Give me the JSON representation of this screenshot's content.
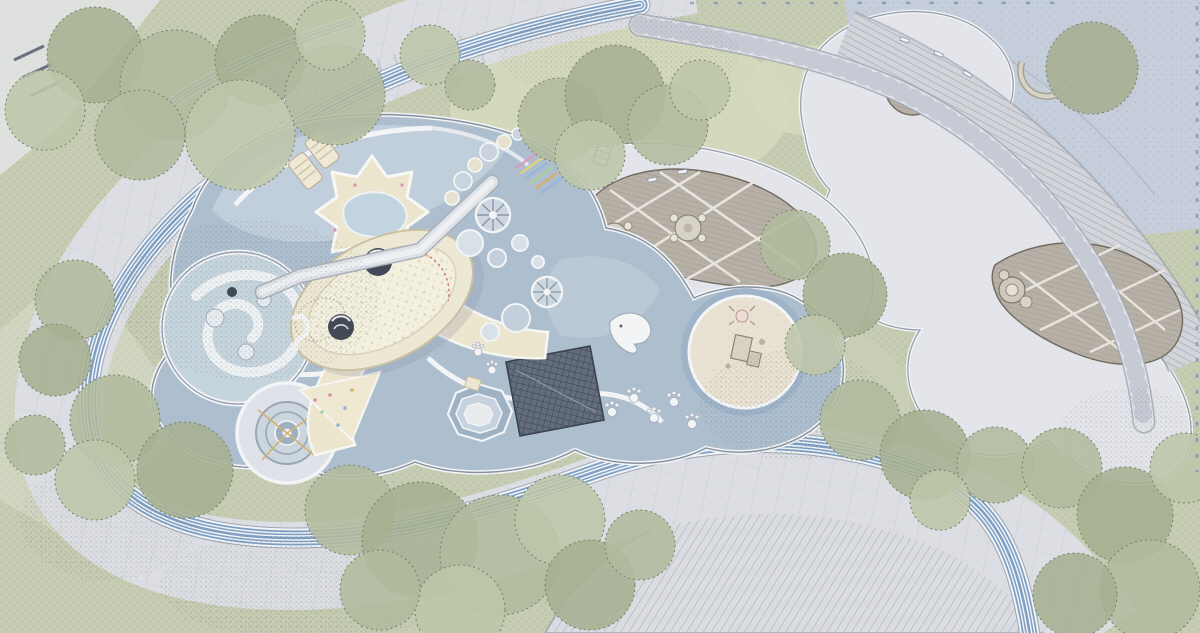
{
  "plan": {
    "kind": "landscape-playground-masterplan-aerial-plan",
    "visible_text": [],
    "features": [
      {
        "name": "running-track",
        "desc": "blue-and-white striped looping jogging track around the play garden"
      },
      {
        "name": "paved-ring-walk",
        "desc": "wide pale paved promenade band with plank joints and steps"
      },
      {
        "name": "playground-surface",
        "desc": "organic blue rubber play surface amoeba"
      },
      {
        "name": "spiral-water-play",
        "desc": "circular spiral play channel with balls"
      },
      {
        "name": "spinner-carousel",
        "desc": "concentric-ring ground carousel"
      },
      {
        "name": "star-sandpit",
        "desc": "star shaped sand pit with small pond"
      },
      {
        "name": "play-pod-structure",
        "desc": "large cream play pod with domes, bridge and flaring slides"
      },
      {
        "name": "climbing-net-panel",
        "desc": "dark gridded climbing net parallelogram"
      },
      {
        "name": "sand-circle",
        "desc": "round sand play circle with central pavilion"
      },
      {
        "name": "picnic-deck",
        "desc": "teardrop timber deck with two round picnic tables"
      },
      {
        "name": "pavilion-deck",
        "desc": "crescent timber deck with small pavilion"
      },
      {
        "name": "right-plaza",
        "desc": "light plaza with circular timber cutout"
      },
      {
        "name": "water-plaza",
        "desc": "blue-grey dotted water plaza with boardwalk crescent"
      },
      {
        "name": "striped-plaza",
        "desc": "large diagonal-striped paving field at bottom"
      },
      {
        "name": "loop-road",
        "desc": "curving jointed road through the plazas"
      },
      {
        "name": "rainbow-steps",
        "desc": "small multicoloured steps"
      },
      {
        "name": "animal-figures",
        "desc": "white whale, seahorse, crab and paw-print play markers"
      },
      {
        "name": "tree-canopies",
        "desc": "stippled green tree canopies and lawns"
      }
    ],
    "palette": {
      "paper": "#e9eae6",
      "lawn": "#c6ccb2",
      "lawn_light": "#d5dabf",
      "canopy_a": "#b2bb9d",
      "canopy_b": "#a6b091",
      "canopy_c": "#bec6aa",
      "canopy_edge": "#76806a",
      "speck": "#5d6552",
      "plaza": "#e4e5ea",
      "plaza_edge": "#979eab",
      "band": "#dcdee3",
      "band_joint": "#c2c5ce",
      "track_blue": "#7e9fc3",
      "track_white": "#f1f4f7",
      "track_edge": "#69788c",
      "stripe_bg": "#dbdce1",
      "stripe_line": "#a9aeba",
      "boardwalk_bg": "#d2d4da",
      "boardwalk_line": "#9aa0ab",
      "water_bg": "#c5ceda",
      "water_dot": "#a4b1c2",
      "road_fill": "#e0e2e8",
      "road_edge": "#a2a8b4",
      "play_surface": "#adbecf",
      "play_light": "#c6d2de",
      "path_white": "#f2f4f6",
      "deck_wood": "#b7b0a6",
      "deck_line": "#968e83",
      "lattice": "#e8e5de",
      "sand": "#e9e1d1",
      "sand_ring": "#9fb2c8",
      "cream": "#ece6cf",
      "cream_edge": "#c9c1a4",
      "panel_dark": "#636d7b",
      "panel_line": "#3a424e",
      "dome_dark": "#414a56",
      "accent_pink": "#dc9cbe",
      "accent_yellow": "#dfd285",
      "accent_blue": "#9ab5da",
      "accent_green": "#a9cf9e",
      "accent_gold": "#d4b26e",
      "tick_blue": "#5c7ab5",
      "wash_white": "#f4f5f2"
    }
  }
}
